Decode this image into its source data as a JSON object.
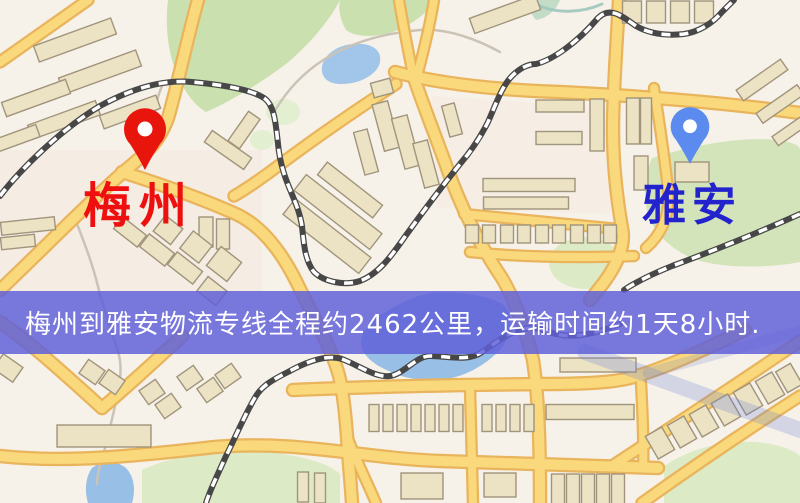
{
  "banner": {
    "text": "梅州到雅安物流专线全程约2462公里，运输时间约1天8小时.",
    "bg": "rgba(95,95,217,0.84)",
    "fg": "#ffffff"
  },
  "markers": [
    {
      "id": "origin",
      "label": "梅州",
      "tip_x": 145,
      "tip_y": 170,
      "scale": 1.0,
      "pin_color": "#e8150c",
      "label_color": "#ee0f0f",
      "label_x": 139,
      "label_y": 222,
      "font_size": 48,
      "letter_spacing": 8
    },
    {
      "id": "destination",
      "label": "雅安",
      "tip_x": 690,
      "tip_y": 164,
      "scale": 0.92,
      "pin_color": "#5b8bee",
      "label_color": "#2323cd",
      "label_x": 692,
      "label_y": 220,
      "font_size": 44,
      "letter_spacing": 6
    }
  ],
  "map": {
    "width": 800,
    "height": 503,
    "bg": "#f7f2e9",
    "road_fill": "#f9d97c",
    "road_casing": "#e9b45c",
    "minor_stroke": "#cbc3b5",
    "building_fill": "#ece2c4",
    "building_stroke": "#a0947c",
    "rail_dark": "#474747",
    "rail_light": "#ffffff",
    "pin_hole": "#ffffff",
    "tints": [
      {
        "d": "M0 150 L262 150 L262 292 L0 292 Z",
        "fill": "#f4e8df",
        "opacity": 0.5
      },
      {
        "d": "M432 96 L612 108 L610 214 L436 208 Z",
        "fill": "#f4e8df",
        "opacity": 0.45
      }
    ],
    "parks": [
      {
        "d": "M 168 0 L 340 0 C 330 20 310 44 286 64 C 262 82 230 102 206 112 C 192 104 180 86 172 60 C 166 38 166 16 168 0 Z",
        "fill": "#cae0ae"
      },
      {
        "d": "M 340 0 L 436 0 C 430 10 416 22 398 30 C 378 38 356 38 346 30 C 340 20 338 8 340 0 Z",
        "fill": "#cae0ae"
      },
      {
        "d": "M 652 158 C 690 146 740 136 776 140 C 794 142 800 146 800 150 L 800 262 C 770 268 730 268 704 262 C 680 256 660 240 650 220 C 642 200 644 176 652 158 Z",
        "fill": "#d3e4ba"
      },
      {
        "d": "M 142 470 C 170 456 220 448 268 452 C 304 456 330 464 340 474 L 340 503 L 142 503 Z",
        "fill": "#dcebc6"
      },
      {
        "d": "M 664 466 C 688 450 720 440 756 442 C 778 444 794 450 800 456 L 800 503 L 664 503 Z",
        "fill": "#dcebc6"
      },
      {
        "d": "M 532 0 L 560 0 C 556 10 548 18 536 20 C 530 14 530 6 532 0 Z",
        "fill": "#c2dcc8"
      }
    ],
    "park_dots": [
      {
        "cx": 283,
        "cy": 112,
        "rx": 17,
        "ry": 13,
        "fill": "#e2efd0"
      },
      {
        "cx": 262,
        "cy": 140,
        "rx": 12,
        "ry": 10,
        "fill": "#e2efd0"
      },
      {
        "cx": 585,
        "cy": 263,
        "rx": 36,
        "ry": 26,
        "fill": "#dcebc6"
      }
    ],
    "water": [
      {
        "d": "M 322 72 C 320 58 334 46 352 44 C 372 42 382 50 380 62 C 378 74 360 84 342 84 C 330 84 324 80 322 72 Z",
        "fill": "#a2c6ea"
      },
      {
        "d": "M 430 293 C 452 291 486 294 502 304 C 514 312 512 330 504 344 C 494 360 470 374 452 378 C 434 382 410 380 396 374 C 380 368 366 360 362 348 C 358 336 368 322 382 314 C 398 304 414 296 430 293 Z",
        "fill": "#98bfe6"
      },
      {
        "d": "M 92 468 C 102 460 116 460 126 468 C 134 476 136 490 132 503 L 88 503 C 84 490 86 476 92 468 Z",
        "fill": "#98bfe6"
      }
    ],
    "streams": [
      {
        "d": "M 532 2 C 556 16 584 12 602 4",
        "stroke": "#9fc7bd",
        "w": 3,
        "opacity": 0.9
      }
    ],
    "minor_roads": [
      {
        "d": "M 162 86 C 152 108 156 130 148 150"
      },
      {
        "d": "M 77 224 C 88 252 95 272 100 295 L 118 352 C 125 372 116 400 110 428 C 104 456 97 470 97 484"
      },
      {
        "d": "M 272 116 C 300 64 350 36 420 30 C 448 28 478 40 500 52"
      }
    ],
    "roads": [
      {
        "d": "M 0 62 L 88 0",
        "w": 9
      },
      {
        "d": "M 0 290 C 40 252 95 196 128 168 C 150 150 160 140 168 118 C 176 92 188 35 198 0",
        "w": 10
      },
      {
        "d": "M 122 172 C 160 184 205 200 236 214 C 262 226 282 252 298 285 C 312 314 330 345 338 372 C 344 392 346 424 347 436 C 349 468 351 485 352 503",
        "w": 10
      },
      {
        "d": "M 347 436 C 356 460 367 482 376 503",
        "w": 8
      },
      {
        "d": "M 396 84 C 350 114 310 142 278 166 C 262 178 248 188 234 196",
        "w": 9
      },
      {
        "d": "M 414 78 C 425 110 437 140 447 168 C 460 205 480 245 498 272 C 512 292 526 330 533 360 C 539 400 540 450 540 503",
        "w": 10
      },
      {
        "d": "M 395 72 C 440 84 500 90 560 92 C 640 96 720 102 800 113",
        "w": 10
      },
      {
        "d": "M 619 0 C 617 40 613 90 613 130 C 613 170 618 205 622 228 C 626 246 616 268 598 290 L 590 300",
        "w": 10
      },
      {
        "d": "M 654 88 C 659 120 665 160 668 190 C 670 212 664 232 646 248",
        "w": 8
      },
      {
        "d": "M 414 80 C 408 50 403 25 399 0",
        "w": 8
      },
      {
        "d": "M 416 80 C 424 50 430 25 434 0",
        "w": 8
      },
      {
        "d": "M 464 214 C 510 218 565 224 618 229",
        "w": 8
      },
      {
        "d": "M 470 252 C 520 257 580 258 634 256",
        "w": 8
      },
      {
        "d": "M 0 322 C 24 338 56 366 102 408",
        "w": 10
      },
      {
        "d": "M 102 408 C 128 386 152 364 182 336",
        "w": 10
      },
      {
        "d": "M 0 456 C 70 464 150 454 215 447 C 300 440 360 458 440 461 C 500 463 600 466 658 468",
        "w": 10
      },
      {
        "d": "M 293 390 C 360 387 450 385 540 384 C 580 384 610 383 630 378 C 660 370 700 352 745 330",
        "w": 10
      },
      {
        "d": "M 612 466 C 676 424 740 382 800 341",
        "w": 9
      },
      {
        "d": "M 642 503 C 695 465 750 428 800 396",
        "w": 9
      },
      {
        "d": "M 470 388 L 473 503",
        "w": 8
      },
      {
        "d": "M 641 383 C 643 420 644 445 643 468",
        "w": 8
      }
    ],
    "buildings": [
      [
        75,
        40,
        82,
        17,
        -20
      ],
      [
        100,
        72,
        82,
        17,
        -20
      ],
      [
        36,
        98,
        68,
        15,
        -20
      ],
      [
        64,
        120,
        72,
        15,
        -20
      ],
      [
        12,
        140,
        55,
        13,
        -20
      ],
      [
        130,
        112,
        60,
        14,
        -20
      ],
      [
        206,
        232,
        14,
        30,
        0
      ],
      [
        223,
        234,
        13,
        30,
        0
      ],
      [
        228,
        150,
        48,
        14,
        35
      ],
      [
        244,
        130,
        14,
        36,
        35
      ],
      [
        130,
        232,
        30,
        15,
        38
      ],
      [
        157,
        250,
        32,
        16,
        38
      ],
      [
        185,
        268,
        32,
        16,
        38
      ],
      [
        168,
        230,
        22,
        20,
        38
      ],
      [
        196,
        247,
        24,
        22,
        38
      ],
      [
        224,
        264,
        26,
        24,
        38
      ],
      [
        212,
        291,
        24,
        18,
        38
      ],
      [
        28,
        226,
        54,
        13,
        -6
      ],
      [
        18,
        242,
        34,
        12,
        -6
      ],
      [
        386,
        126,
        16,
        48,
        -15
      ],
      [
        406,
        142,
        16,
        52,
        -15
      ],
      [
        426,
        164,
        15,
        46,
        -15
      ],
      [
        366,
        152,
        14,
        44,
        -15
      ],
      [
        452,
        120,
        13,
        32,
        -15
      ],
      [
        382,
        88,
        20,
        15,
        -15
      ],
      [
        350,
        190,
        70,
        16,
        38
      ],
      [
        338,
        212,
        96,
        20,
        38
      ],
      [
        327,
        236,
        96,
        20,
        38
      ],
      [
        472,
        234,
        13,
        18,
        0
      ],
      [
        489,
        234,
        13,
        18,
        0
      ],
      [
        507,
        234,
        13,
        18,
        0
      ],
      [
        524,
        234,
        13,
        18,
        0
      ],
      [
        542,
        234,
        13,
        18,
        0
      ],
      [
        559,
        234,
        13,
        18,
        0
      ],
      [
        577,
        234,
        13,
        18,
        0
      ],
      [
        594,
        234,
        13,
        18,
        0
      ],
      [
        610,
        234,
        13,
        18,
        0
      ],
      [
        529,
        185,
        92,
        13,
        0
      ],
      [
        526,
        203,
        85,
        12,
        0
      ],
      [
        633,
        121,
        13,
        46,
        0
      ],
      [
        646,
        121,
        11,
        46,
        0
      ],
      [
        641,
        173,
        14,
        34,
        0
      ],
      [
        692,
        172,
        34,
        20,
        0
      ],
      [
        632,
        12,
        19,
        22,
        0
      ],
      [
        656,
        12,
        19,
        22,
        0
      ],
      [
        680,
        12,
        19,
        22,
        0
      ],
      [
        704,
        12,
        19,
        22,
        0
      ],
      [
        762,
        80,
        54,
        13,
        -35
      ],
      [
        780,
        104,
        50,
        12,
        -35
      ],
      [
        794,
        128,
        46,
        11,
        -35
      ],
      [
        560,
        106,
        48,
        12,
        0
      ],
      [
        559,
        138,
        46,
        13,
        0
      ],
      [
        597,
        125,
        14,
        52,
        0
      ],
      [
        505,
        14,
        70,
        16,
        -20
      ],
      [
        92,
        372,
        20,
        17,
        35
      ],
      [
        112,
        382,
        20,
        17,
        35
      ],
      [
        152,
        392,
        20,
        17,
        -35
      ],
      [
        168,
        406,
        20,
        17,
        -35
      ],
      [
        190,
        378,
        20,
        17,
        -35
      ],
      [
        210,
        390,
        20,
        17,
        -35
      ],
      [
        228,
        376,
        20,
        17,
        -35
      ],
      [
        8,
        368,
        24,
        18,
        35
      ],
      [
        104,
        436,
        94,
        22,
        0
      ],
      [
        374,
        418,
        10,
        27,
        0
      ],
      [
        388,
        418,
        10,
        27,
        0
      ],
      [
        402,
        418,
        10,
        27,
        0
      ],
      [
        416,
        418,
        10,
        27,
        0
      ],
      [
        430,
        418,
        10,
        27,
        0
      ],
      [
        444,
        418,
        10,
        27,
        0
      ],
      [
        458,
        418,
        10,
        27,
        0
      ],
      [
        487,
        418,
        10,
        27,
        0
      ],
      [
        501,
        418,
        10,
        27,
        0
      ],
      [
        515,
        418,
        10,
        27,
        0
      ],
      [
        529,
        418,
        10,
        27,
        0
      ],
      [
        590,
        412,
        88,
        15,
        0
      ],
      [
        598,
        365,
        76,
        14,
        0
      ],
      [
        422,
        486,
        42,
        26,
        0
      ],
      [
        500,
        485,
        32,
        24,
        0
      ],
      [
        303,
        487,
        11,
        30,
        0
      ],
      [
        320,
        488,
        11,
        30,
        0
      ],
      [
        558,
        489,
        13,
        30,
        0
      ],
      [
        573,
        489,
        13,
        30,
        0
      ],
      [
        588,
        489,
        13,
        30,
        0
      ],
      [
        603,
        489,
        13,
        30,
        0
      ],
      [
        618,
        489,
        13,
        30,
        0
      ],
      [
        660,
        443,
        19,
        26,
        -30
      ],
      [
        682,
        432,
        19,
        26,
        -30
      ],
      [
        704,
        421,
        19,
        26,
        -30
      ],
      [
        726,
        410,
        19,
        26,
        -30
      ],
      [
        748,
        399,
        19,
        26,
        -30
      ],
      [
        770,
        388,
        19,
        26,
        -30
      ],
      [
        789,
        378,
        17,
        24,
        -30
      ]
    ],
    "railways": [
      {
        "d": "M 0 196 C 20 170 60 130 100 106 C 140 84 170 80 192 82 C 225 85 252 90 264 98 C 276 106 276 130 279 152 C 284 185 298 200 302 226 C 304 248 306 262 314 272 C 324 282 345 286 360 281 C 378 274 390 258 404 238 C 424 210 444 184 460 164 C 472 150 480 138 488 122 C 496 104 502 86 512 76 C 520 68 528 64 536 64 C 552 60 576 44 598 18 C 610 6 622 16 636 26 C 650 34 666 36 684 34 C 698 32 712 24 722 12 L 734 0"
      },
      {
        "d": "M 620 324 C 590 336 566 340 544 330 C 520 322 500 340 482 352 C 468 362 448 356 430 356 C 416 356 404 374 390 376 C 376 378 360 366 342 359 C 326 354 306 362 288 372 C 272 380 262 386 256 396 C 246 412 236 436 226 456 C 218 474 210 490 206 503"
      },
      {
        "d": "M 800 214 C 760 232 710 252 672 266 C 652 274 636 282 624 290"
      }
    ],
    "overlays": [
      {
        "d": "M 585 352 L 800 430",
        "stroke": "#6b7fd8",
        "w": 16,
        "opacity": 0.26
      },
      {
        "d": "M 648 373 L 800 331",
        "stroke": "#6b7fd8",
        "w": 11,
        "opacity": 0.2
      }
    ]
  }
}
